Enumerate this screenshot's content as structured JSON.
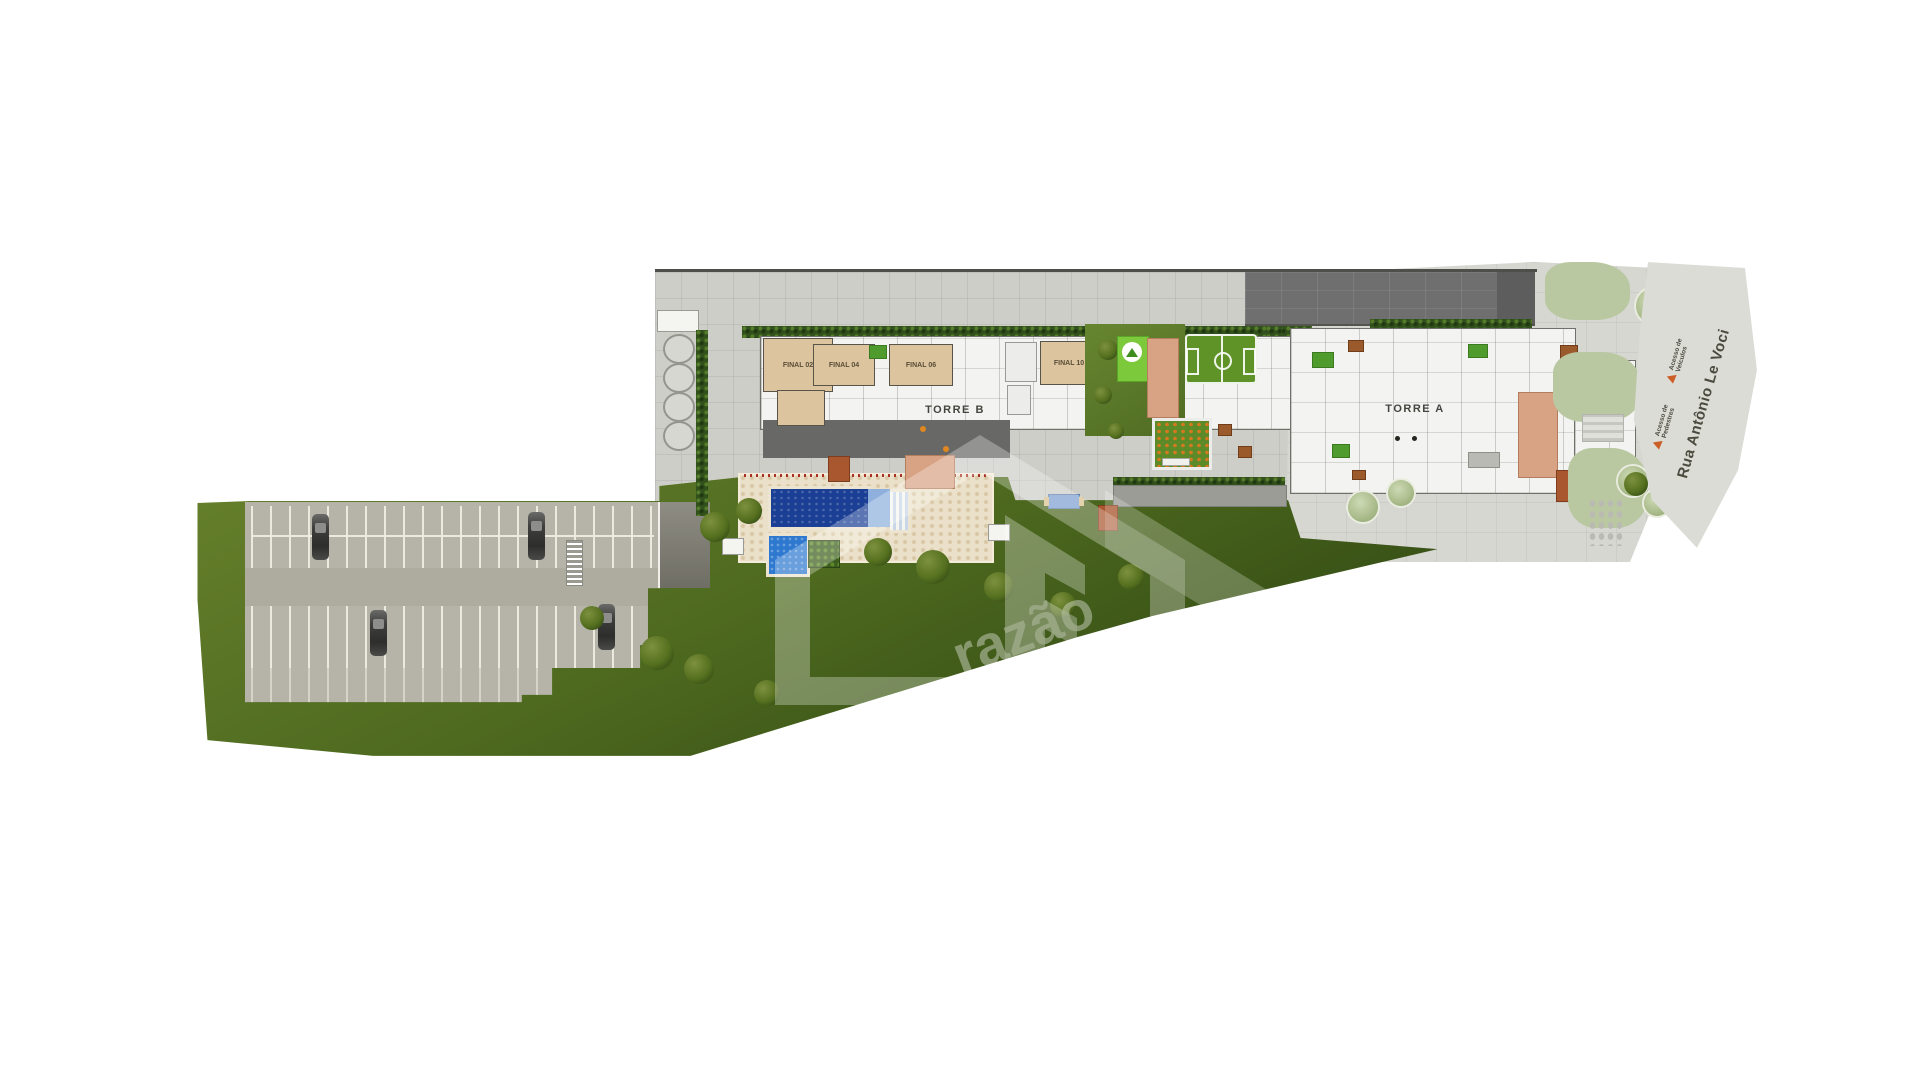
{
  "site": {
    "towers": {
      "b": {
        "label": "TORRE B",
        "units": [
          "FINAL 02",
          "FINAL 04",
          "FINAL 06",
          "FINAL 10"
        ]
      },
      "a": {
        "label": "TORRE A"
      }
    },
    "street": {
      "name": "Rua Antônio Le Voci"
    },
    "access": {
      "vehicles": {
        "line1": "Acesso de",
        "line2": "Veículos"
      },
      "pedestrians": {
        "line1": "Acesso de",
        "line2": "Pedestres"
      }
    },
    "watermark": {
      "text": "razão"
    },
    "colors": {
      "lawn": "#4e6a1f",
      "pavement": "#cdcec8",
      "roof_dark": "#6b6c6b",
      "deck": "#ebe1ca",
      "pool": "#1b3f94",
      "kids_pool": "#2e79cf",
      "terracotta": "#a9572f",
      "salmon": "#d8a285",
      "unit_beige": "#dcc49e",
      "soccer_green": "#5f9328",
      "playground_green": "#7cc93b",
      "access_orange": "#cc5f28",
      "street_text": "#4a4a3e"
    }
  }
}
